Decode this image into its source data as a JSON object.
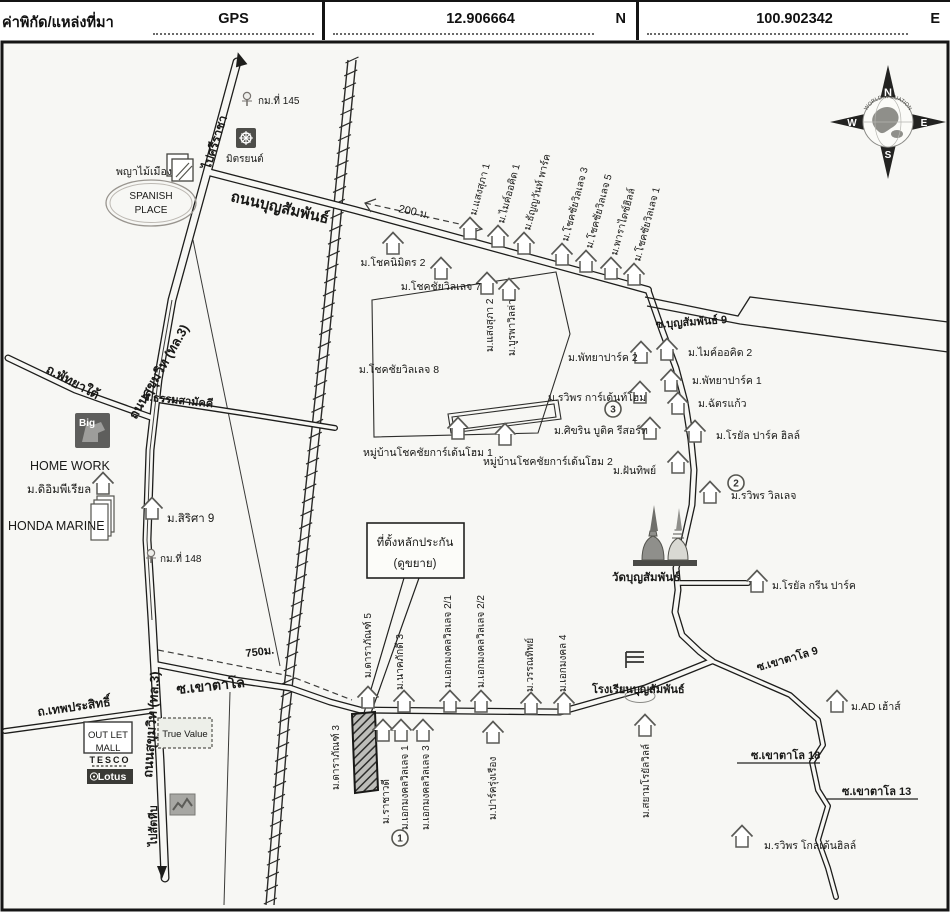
{
  "header": {
    "title": "ค่าพิกัด/แหล่งที่มา",
    "gps_label": "GPS",
    "lat": "12.906664",
    "lat_dir": "N",
    "lon": "100.902342",
    "lon_dir": "E"
  },
  "compass": {
    "n": "N",
    "e": "E",
    "s": "S",
    "w": "W",
    "brand": "WORLD VALUATION"
  },
  "map": {
    "callout": {
      "line1": "ที่ตั้งหลักประกัน",
      "line2": "(ดูขยาย)"
    },
    "markers": [
      {
        "n": "1",
        "x": 400,
        "y": 838
      },
      {
        "n": "2",
        "x": 736,
        "y": 483
      },
      {
        "n": "3",
        "x": 613,
        "y": 409
      }
    ],
    "labels": [
      {
        "t": "ไปศรีราชา",
        "x": 210,
        "y": 170,
        "r": -72,
        "s": 12,
        "b": true
      },
      {
        "t": "กม.ที่ 145",
        "x": 258,
        "y": 104,
        "s": 10
      },
      {
        "t": "มิตรยนต์",
        "x": 226,
        "y": 162,
        "s": 10
      },
      {
        "t": "พญาไม้เมือง",
        "x": 116,
        "y": 175,
        "s": 10.5
      },
      {
        "t": "SPANISH",
        "x": 151,
        "y": 199,
        "s": 10,
        "a": "middle"
      },
      {
        "t": "PLACE",
        "x": 151,
        "y": 213,
        "s": 10,
        "a": "middle"
      },
      {
        "t": "ถนนบุญสัมพันธ์",
        "x": 230,
        "y": 201,
        "r": 13,
        "s": 15,
        "b": true
      },
      {
        "t": "200 ม.",
        "x": 398,
        "y": 212,
        "r": 12,
        "s": 11
      },
      {
        "t": "ม.โชคนิมิตร 2",
        "x": 393,
        "y": 266,
        "s": 10.5,
        "a": "middle"
      },
      {
        "t": "ม.โชคชัยวิลเลจ 7",
        "x": 441,
        "y": 290,
        "s": 10.5,
        "a": "middle"
      },
      {
        "t": "ม.แสงสุภา 1",
        "x": 476,
        "y": 216,
        "r": -75,
        "s": 10
      },
      {
        "t": "ม.ไมค์ออคิด 1",
        "x": 504,
        "y": 224,
        "r": -75,
        "s": 10
      },
      {
        "t": "ม.ธัญญวันท์ พาร์ค",
        "x": 530,
        "y": 231,
        "r": -75,
        "s": 10
      },
      {
        "t": "ม.โชคชัยวิลเลจ 3",
        "x": 568,
        "y": 242,
        "r": -75,
        "s": 10
      },
      {
        "t": "ม.โชคชัยวิลเลจ 5",
        "x": 592,
        "y": 249,
        "r": -75,
        "s": 10
      },
      {
        "t": "ม.พาราไดซ์ฮิลล์",
        "x": 617,
        "y": 256,
        "r": -75,
        "s": 10
      },
      {
        "t": "ม.โชคชัยวิลเลจ 1",
        "x": 640,
        "y": 262,
        "r": -75,
        "s": 10
      },
      {
        "t": "ม.แสงสุภา 2",
        "x": 493,
        "y": 352,
        "r": -90,
        "s": 10
      },
      {
        "t": "ม.บูรพาวิลล่า",
        "x": 515,
        "y": 356,
        "r": -90,
        "s": 10
      },
      {
        "t": "ม.โชคชัยวิลเลจ 8",
        "x": 399,
        "y": 373,
        "s": 10.5,
        "a": "middle"
      },
      {
        "t": "ซ.บุญสัมพันธ์ 9",
        "x": 656,
        "y": 328,
        "r": -4,
        "s": 11,
        "b": true
      },
      {
        "t": "ม.พัทยาปาร์ค 2",
        "x": 568,
        "y": 361,
        "s": 10.5
      },
      {
        "t": "ม.ไมค์ออคิด 2",
        "x": 688,
        "y": 356,
        "s": 10.5
      },
      {
        "t": "ม.พัทยาปาร์ค 1",
        "x": 692,
        "y": 384,
        "s": 10.5
      },
      {
        "t": "ม.ฉัตรแก้ว",
        "x": 698,
        "y": 407,
        "s": 10.5
      },
      {
        "t": "ม.รวิพร การ์เด้นท์โฮม",
        "x": 548,
        "y": 401,
        "s": 10.5
      },
      {
        "t": "ม.ศิขริน บูติค รีสอร์ท",
        "x": 554,
        "y": 434,
        "s": 10.5
      },
      {
        "t": "ม.โรยัล ปาร์ค ฮิลล์",
        "x": 716,
        "y": 439,
        "s": 10.5
      },
      {
        "t": "ม.ฝันทิพย์",
        "x": 613,
        "y": 474,
        "s": 10.5
      },
      {
        "t": "ม.รวิพร วิลเลจ",
        "x": 731,
        "y": 499,
        "s": 10.5
      },
      {
        "t": "หมู่บ้านโชคชัยการ์เด้นโฮม 1",
        "x": 363,
        "y": 456,
        "s": 10.5
      },
      {
        "t": "หมู่บ้านโชคชัยการ์เด้นโฮม 2",
        "x": 483,
        "y": 465,
        "s": 10.5
      },
      {
        "t": "วัดบุญสัมพันธ์",
        "x": 612,
        "y": 581,
        "s": 11.5,
        "b": true
      },
      {
        "t": "ม.โรยัล กรีน ปาร์ค",
        "x": 772,
        "y": 589,
        "s": 10.5
      },
      {
        "t": "ถนนสุขุมวิท (ทล.3)",
        "x": 136,
        "y": 420,
        "r": -60,
        "s": 13,
        "b": true
      },
      {
        "t": "ถนนสุขุมวิท (ทล.3)",
        "x": 152,
        "y": 778,
        "r": -86,
        "s": 13,
        "b": true
      },
      {
        "t": "ถ.พัทยาใต้",
        "x": 45,
        "y": 372,
        "r": 28,
        "s": 13,
        "b": true
      },
      {
        "t": "ซ.ธรรมสามัคคี",
        "x": 142,
        "y": 400,
        "r": 6,
        "s": 11,
        "b": true
      },
      {
        "t": "HOME WORK",
        "x": 30,
        "y": 470,
        "s": 12.5
      },
      {
        "t": "ม.ดิอิมพีเรียล",
        "x": 27,
        "y": 493,
        "s": 11.5
      },
      {
        "t": "HONDA MARINE",
        "x": 8,
        "y": 530,
        "s": 12.5
      },
      {
        "t": "ม.สิริศา 9",
        "x": 167,
        "y": 522,
        "s": 11.5
      },
      {
        "t": "กม.ที่ 148",
        "x": 160,
        "y": 562,
        "s": 10
      },
      {
        "t": "750ม.",
        "x": 246,
        "y": 657,
        "r": -7,
        "s": 11,
        "b": true
      },
      {
        "t": "ซ.เขาตาโล",
        "x": 177,
        "y": 694,
        "r": -6,
        "s": 14,
        "b": true
      },
      {
        "t": "ม.ดาราภัณฑ์ 5",
        "x": 371,
        "y": 678,
        "r": -90,
        "s": 10
      },
      {
        "t": "ม.นาคภักดี 3",
        "x": 403,
        "y": 690,
        "r": -90,
        "s": 10
      },
      {
        "t": "ม.เอกมงคลวิลเลจ 2/1",
        "x": 451,
        "y": 688,
        "r": -90,
        "s": 10
      },
      {
        "t": "ม.เอกมงคลวิลเลจ 2/2",
        "x": 484,
        "y": 688,
        "r": -90,
        "s": 10
      },
      {
        "t": "ม.วรรณทิพย์",
        "x": 533,
        "y": 692,
        "r": -90,
        "s": 10
      },
      {
        "t": "ม.เอกมงคล 4",
        "x": 566,
        "y": 692,
        "r": -90,
        "s": 10
      },
      {
        "t": "โรงเรียนบุญสัมพันธ์",
        "x": 592,
        "y": 693,
        "s": 11,
        "b": true
      },
      {
        "t": "ซ.เขาตาโล 9",
        "x": 758,
        "y": 671,
        "r": -16,
        "s": 11,
        "b": true
      },
      {
        "t": "ม.AD เฮ้าส์",
        "x": 851,
        "y": 710,
        "s": 10.5
      },
      {
        "t": "ม.ดาราภัณฑ์ 3",
        "x": 339,
        "y": 790,
        "r": -90,
        "s": 10
      },
      {
        "t": "ม.ราชาวดี",
        "x": 389,
        "y": 824,
        "r": -90,
        "s": 10
      },
      {
        "t": "ม.เอกมงคลวิลเลจ 1",
        "x": 408,
        "y": 830,
        "r": -90,
        "s": 10
      },
      {
        "t": "ม.เอกมงคลวิลเลจ 3",
        "x": 429,
        "y": 830,
        "r": -90,
        "s": 10
      },
      {
        "t": "ม.ปาร์ครุ่งเรือง",
        "x": 496,
        "y": 820,
        "r": -90,
        "s": 10
      },
      {
        "t": "ม.สยามโรยัลวิลล์",
        "x": 649,
        "y": 818,
        "r": -90,
        "s": 10
      },
      {
        "t": "ซ.เขาตาโล 18",
        "x": 751,
        "y": 759,
        "s": 11,
        "b": true
      },
      {
        "t": "ซ.เขาตาโล 13",
        "x": 842,
        "y": 795,
        "s": 11,
        "b": true
      },
      {
        "t": "ม.รวิพร โกลเด้นฮิลล์",
        "x": 764,
        "y": 849,
        "s": 10.5
      },
      {
        "t": "ถ.เทพประสิทธิ์",
        "x": 38,
        "y": 716,
        "r": -8,
        "s": 12,
        "b": true
      },
      {
        "t": "ไปสัตหีบ",
        "x": 157,
        "y": 846,
        "r": -90,
        "s": 11,
        "b": true
      },
      {
        "t": "OUT LET",
        "x": 108,
        "y": 738,
        "s": 9.5,
        "a": "middle"
      },
      {
        "t": "MALL",
        "x": 108,
        "y": 751,
        "s": 9.5,
        "a": "middle"
      },
      {
        "t": "True Value",
        "x": 185,
        "y": 737,
        "s": 9.5,
        "a": "middle"
      },
      {
        "t": "TESCO",
        "x": 110,
        "y": 763,
        "s": 9,
        "b": true,
        "a": "middle",
        "ls": 2
      },
      {
        "t": "Lotus",
        "x": 112,
        "y": 780,
        "s": 10.5,
        "b": true,
        "a": "middle",
        "c": "#ffffff"
      },
      {
        "t": "Big",
        "x": 79,
        "y": 426,
        "s": 10,
        "b": true,
        "c": "#ffffff"
      }
    ],
    "houses": [
      [
        470,
        228
      ],
      [
        498,
        236
      ],
      [
        524,
        243
      ],
      [
        562,
        254
      ],
      [
        586,
        261
      ],
      [
        611,
        268
      ],
      [
        634,
        274
      ],
      [
        393,
        243
      ],
      [
        441,
        268
      ],
      [
        487,
        283
      ],
      [
        509,
        289
      ],
      [
        640,
        392
      ],
      [
        650,
        428
      ],
      [
        678,
        462
      ],
      [
        710,
        492
      ],
      [
        757,
        581
      ],
      [
        641,
        352
      ],
      [
        667,
        349
      ],
      [
        671,
        380
      ],
      [
        678,
        403
      ],
      [
        695,
        431
      ],
      [
        458,
        428
      ],
      [
        505,
        434
      ],
      [
        103,
        483
      ],
      [
        152,
        508
      ],
      [
        368,
        697
      ],
      [
        404,
        701
      ],
      [
        450,
        701
      ],
      [
        481,
        701
      ],
      [
        531,
        703
      ],
      [
        564,
        703
      ],
      [
        383,
        730
      ],
      [
        401,
        730
      ],
      [
        423,
        730
      ],
      [
        493,
        732
      ],
      [
        645,
        725
      ],
      [
        837,
        701
      ],
      [
        742,
        836
      ]
    ]
  }
}
